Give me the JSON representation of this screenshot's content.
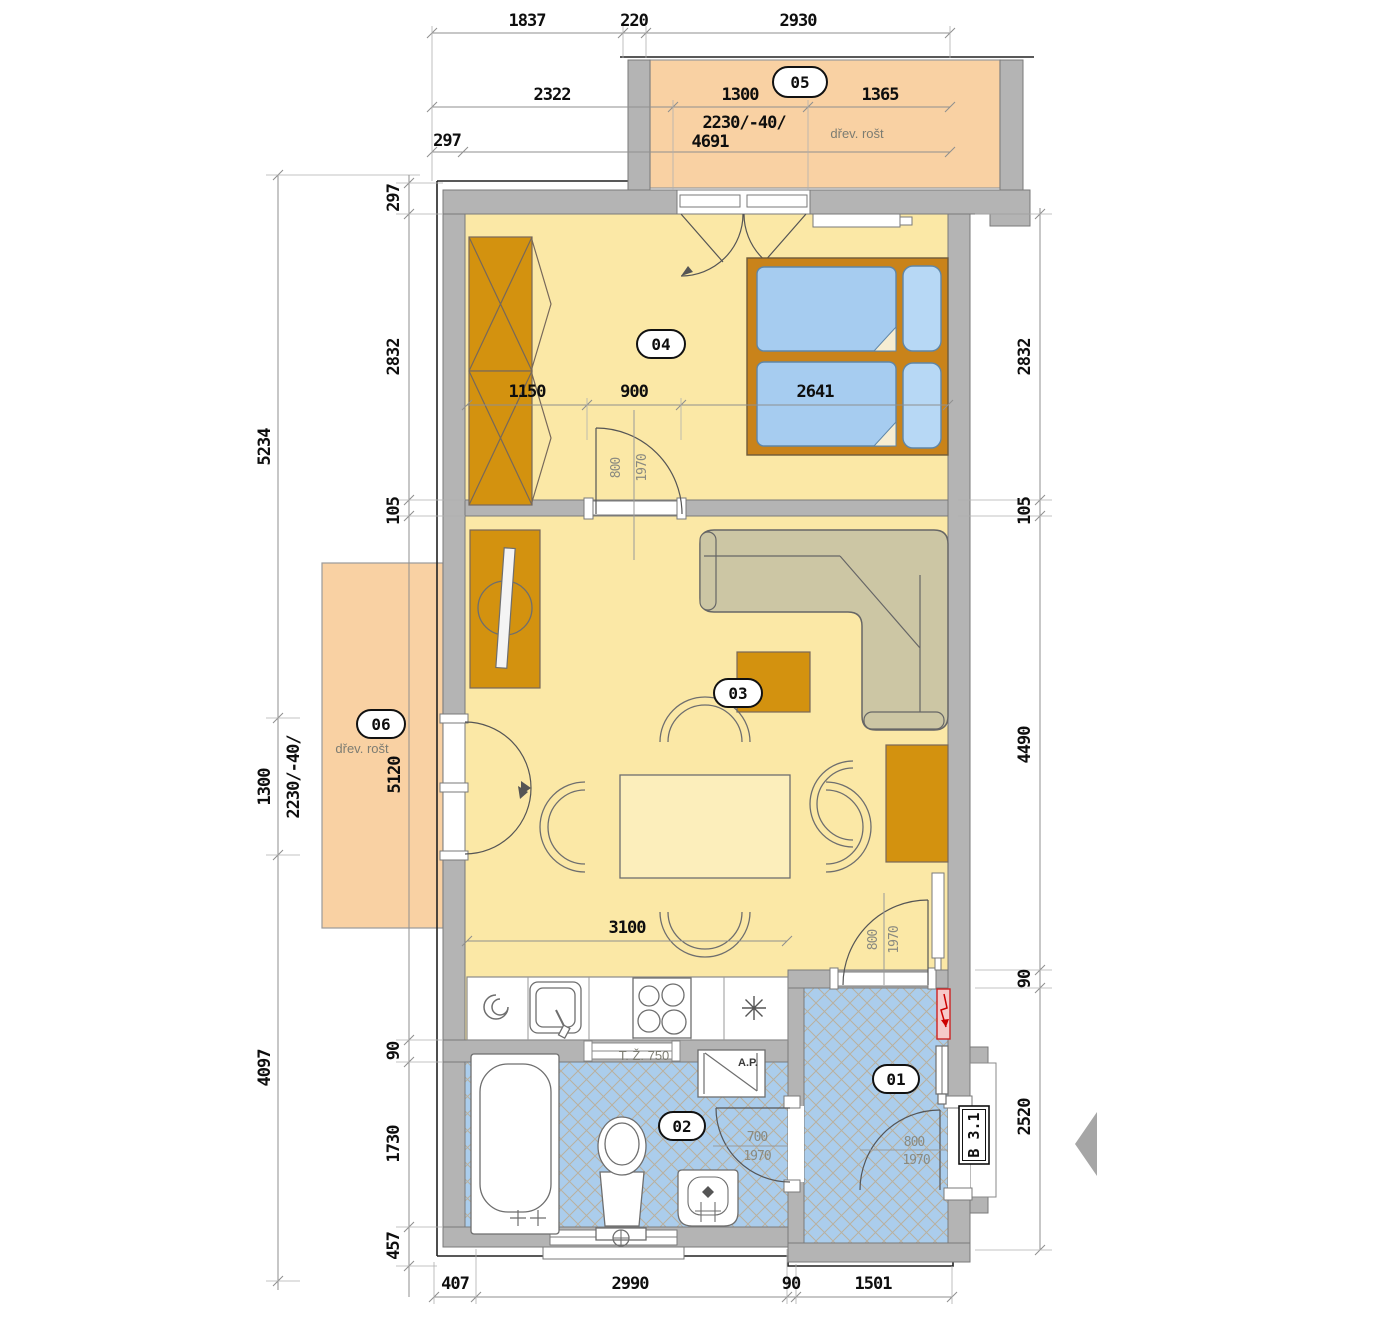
{
  "colors": {
    "floor_yellow": "#fbe8a6",
    "balcony_orange": "#f9d1a3",
    "tile_blue": "#abcdec",
    "tile_line": "#bca98c",
    "wall_gray": "#b4b4b4",
    "furniture_orange": "#d3920f",
    "sofa_beige": "#ccc6a4",
    "mattress_blue": "#a6ccf0",
    "alert_red": "#cc2222"
  },
  "rooms": {
    "hall": "01",
    "bath": "02",
    "living": "03",
    "bedroom": "04",
    "balcony_top": "05",
    "balcony_left": "06"
  },
  "labels": {
    "wood_grate": "dřev. rošt",
    "kitchen_window": "T. Ž. 750",
    "washer": "A.P.",
    "unit_tag": "B 3.1"
  },
  "doors": {
    "bedroom_w": "800",
    "bedroom_h": "1970",
    "living_w": "800",
    "living_h": "1970",
    "bath_w": "700",
    "bath_h": "1970",
    "entry_w": "800",
    "entry_h": "1970"
  },
  "dims": {
    "top": [
      "1837",
      "220",
      "2930"
    ],
    "upper": [
      "2322",
      "1300",
      "1365"
    ],
    "upper2": [
      "297",
      "2230/-40/",
      "4691"
    ],
    "left_outer": [
      "5234",
      "1300",
      "4097"
    ],
    "left_rot": "2230/-40/",
    "left_inner_top": [
      "297",
      "2832",
      "105"
    ],
    "left_inner_bottom": [
      "90",
      "1730",
      "457"
    ],
    "right_top": [
      "2832",
      "105"
    ],
    "right_bottom": [
      "4490",
      "90",
      "2520"
    ],
    "bottom": [
      "407",
      "2990",
      "90",
      "1501"
    ],
    "bedroom": [
      "1150",
      "900",
      "2641"
    ],
    "living": "3100",
    "balcony_left": "5120"
  }
}
